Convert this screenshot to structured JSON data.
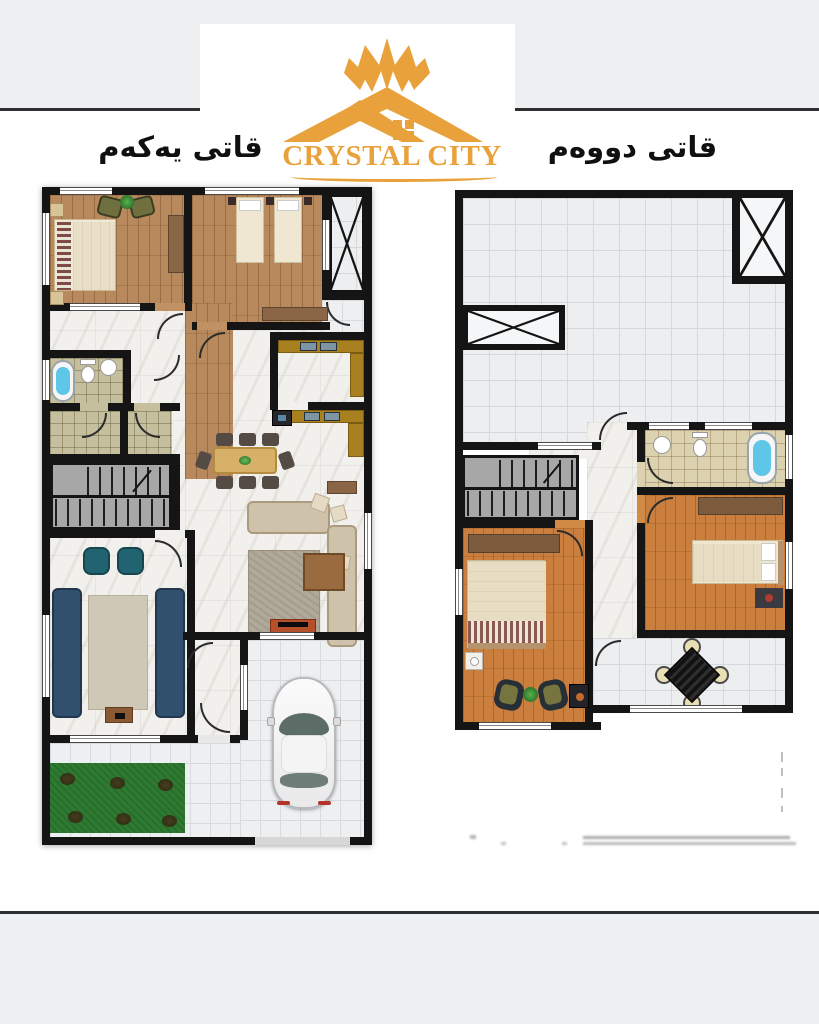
{
  "brand": {
    "name": "CRYSTAL CITY",
    "accent_color": "#E9A23B",
    "icon": "crystal-house-icon"
  },
  "floor_labels": {
    "first_floor": "قاتی یەکەم",
    "second_floor": "قاتی دووەم"
  },
  "palette": {
    "wall": "#151515",
    "page_band": "#edeff0",
    "band_divider": "#2e2e30",
    "marble_floor": "#f2f0ec",
    "terrace_tile": "#eceef0",
    "wood_first_floor": "#b8895c",
    "wood_second_floor": "#cb7f3e",
    "bath_tile_olive": "#c6bf9e",
    "bath_tile_beige": "#dcd2b0",
    "grass": "#2f7a33",
    "bath_water": "#5ec7e8",
    "sofa_navy": "#31506e",
    "armchair_teal": "#1f6470",
    "sofa_beige": "#cfc2aa",
    "dining_table": "#d8b169",
    "kitchen_counter": "#a9801f",
    "tv_stand": "#b5502a",
    "stair_gray": "#a7a7a7",
    "wardrobe_brown": "#7d5c3e"
  }
}
